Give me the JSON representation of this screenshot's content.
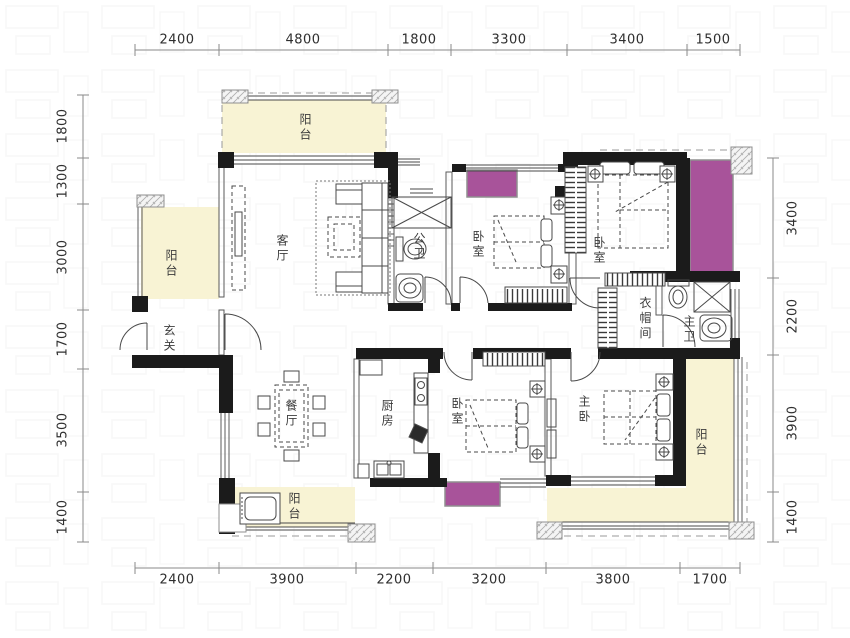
{
  "meta": {
    "type": "apartment-floor-plan"
  },
  "colors": {
    "balcony_fill": "#f8f3d4",
    "highlight_magenta": "#a8539a",
    "wall_black": "#1b1b1b",
    "thin_line": "#555555",
    "dimension_line": "#8a8a8a",
    "dimension_text": "#2e2e2e",
    "label_text": "#3c3c3c"
  },
  "rooms": [
    {
      "id": "balcony-top",
      "label": "阳台"
    },
    {
      "id": "balcony-left",
      "label": "阳台"
    },
    {
      "id": "living-room",
      "label": "客厅"
    },
    {
      "id": "public-bath",
      "label": "公卫"
    },
    {
      "id": "bedroom-a",
      "label": "卧室"
    },
    {
      "id": "bedroom-b",
      "label": "卧室"
    },
    {
      "id": "foyer",
      "label": "玄关"
    },
    {
      "id": "dining-room",
      "label": "餐厅"
    },
    {
      "id": "kitchen",
      "label": "厨房"
    },
    {
      "id": "bedroom-c",
      "label": "卧室"
    },
    {
      "id": "master-bedroom",
      "label": "主卧"
    },
    {
      "id": "cloakroom",
      "label": "衣帽间"
    },
    {
      "id": "master-bath",
      "label": "主卫"
    },
    {
      "id": "balcony-right",
      "label": "阳台"
    },
    {
      "id": "balcony-bottom",
      "label": "阳台"
    }
  ],
  "dimensions": {
    "top": [
      "2400",
      "4800",
      "1800",
      "3300",
      "3400",
      "1500"
    ],
    "bottom": [
      "2400",
      "3900",
      "2200",
      "3200",
      "3800",
      "1700"
    ],
    "left": [
      "1800",
      "1300",
      "3000",
      "1700",
      "3500",
      "1400"
    ],
    "right": [
      "3400",
      "2200",
      "3900",
      "1400"
    ]
  }
}
